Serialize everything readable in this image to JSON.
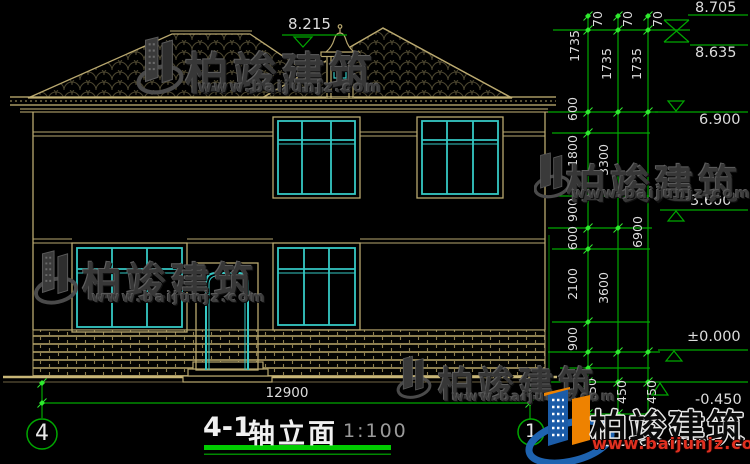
{
  "colors": {
    "line_tan": "#B9A86F",
    "window_cyan": "#35C8C4",
    "dim_green": "#00A800",
    "node_green": "#2FEA2F",
    "logo_blue": "#1B5CA8",
    "logo_orange": "#EE8200",
    "site_red": "#E03020"
  },
  "annotations": {
    "roof_peak_elev": "8.215",
    "elevations": {
      "ridge_cap": "8.705",
      "ridge": "8.635",
      "eave": "6.900",
      "floor2": "3.600",
      "floor1": "±0.000",
      "ground_out": "-0.450"
    },
    "total_width": "12900"
  },
  "dim_chains": {
    "fine": [
      "70",
      "1735",
      "600",
      "1800",
      "900",
      "600",
      "2100",
      "900",
      "450"
    ],
    "floors": [
      "70",
      "1735",
      "3300",
      "3600",
      "450"
    ],
    "total": [
      "70",
      "1735",
      "6900",
      "450"
    ]
  },
  "title_block": {
    "number": "4-1",
    "name": "轴立面",
    "scale": "1:100"
  },
  "axis_bubbles": {
    "left": "4",
    "right": "1"
  },
  "watermark": {
    "brand": "柏竣建筑",
    "site": "www.baijunjz.com"
  },
  "logo": {
    "brand": "柏竣建筑",
    "site": "www.baijunjz.com"
  }
}
